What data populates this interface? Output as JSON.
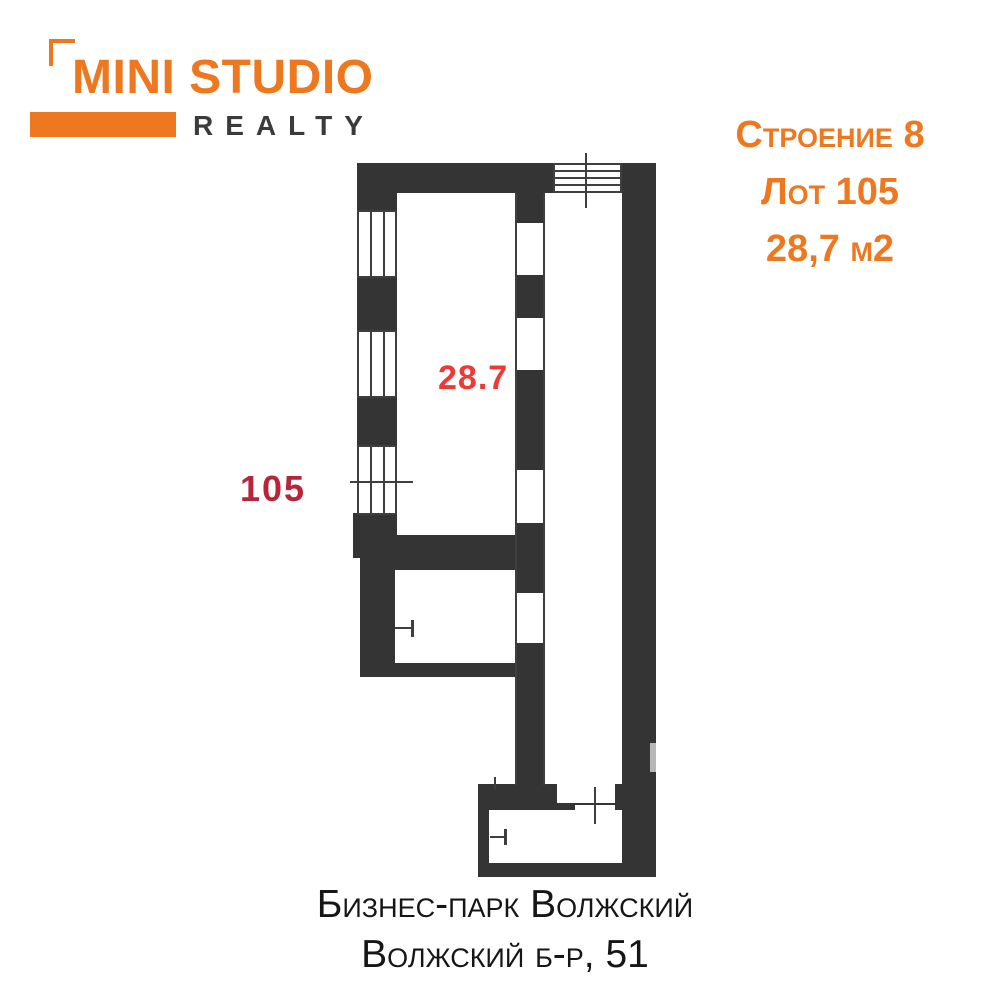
{
  "logo": {
    "title": "MINI STUDIO",
    "subtitle": "REALTY"
  },
  "listing": {
    "building": "Строение 8",
    "lot": "Лот 105",
    "area": "28,7 м2"
  },
  "plan": {
    "area_label": "28.7",
    "lot_label": "105"
  },
  "footer": {
    "line1": "Бизнес-парк Волжский",
    "line2": "Волжский б-р, 51"
  },
  "colors": {
    "orange": "#EE7820",
    "wall": "#343434",
    "line": "#3F3F3F",
    "red": "#EE3A34",
    "crimson": "#B6253A",
    "ink": "#161616",
    "logo_gray": "#3B3B3B",
    "notch_gray": "#B7B7B7"
  }
}
